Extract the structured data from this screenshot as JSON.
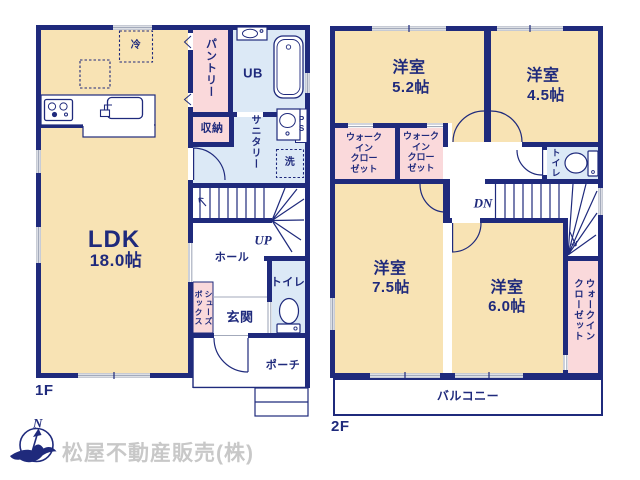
{
  "floor1": {
    "label": "1F",
    "ldk_name": "LDK",
    "ldk_size": "18.0帖",
    "fridge": "冷",
    "pantry": "パントリー",
    "unit_bath": "UB",
    "storage": "収納",
    "sanitary": "サニタリー",
    "pipe_space": "P\nS",
    "laundry": "洗",
    "up": "UP",
    "hall": "ホール",
    "toilet": "トイレ",
    "shoebox_col_left": "ボックス",
    "shoebox_col_right": "シューズ",
    "entrance": "玄関",
    "porch": "ポーチ"
  },
  "floor2": {
    "label": "2F",
    "room_a_name": "洋室",
    "room_a_size": "5.2帖",
    "room_b_name": "洋室",
    "room_b_size": "4.5帖",
    "room_c_name": "洋室",
    "room_c_size": "7.5帖",
    "room_d_name": "洋室",
    "room_d_size": "6.0帖",
    "wic_a": "ウォーク\nイン\nクロー\nゼット",
    "wic_b": "ウォーク\nイン\nクロー\nゼット",
    "wic_c_col_right": "ウォークイン",
    "wic_c_col_left": "クローゼット",
    "toilet": "トイレ",
    "down": "DN",
    "balcony": "バルコニー"
  },
  "footer": {
    "north_mark": "N",
    "company": "松屋不動産販売(株)"
  },
  "colors": {
    "wall_navy": "#1f2a7c",
    "room_cream": "#f8e3b4",
    "closet_pink": "#fad9db",
    "wet_blue": "#dce9f6",
    "window_gray": "#a3aabb",
    "watermark_gray": "#c8c8c8"
  }
}
